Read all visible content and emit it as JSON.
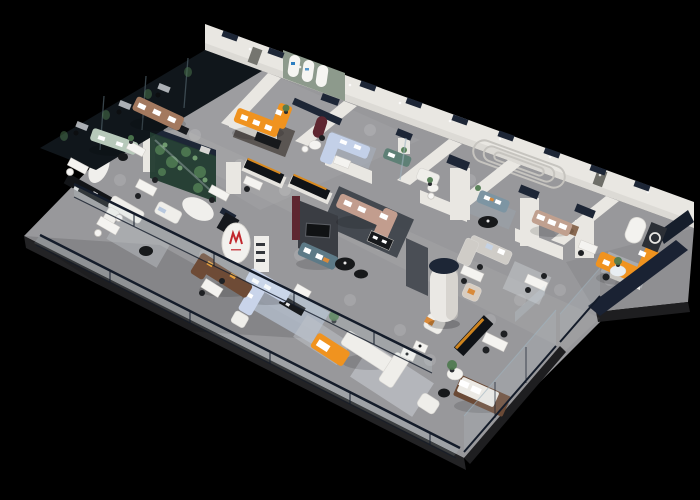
{
  "scene": {
    "render_type": "3d isometric cutaway floor-plan render",
    "subject": "furniture showroom and office interior, elevated axonometric view on black background",
    "areas": [
      "dark glass-walled offices (upper left)",
      "sage and tan sofa displays",
      "glass plant terrarium wall",
      "reception oval with red brand monogram",
      "arched gallery wall with orange corner sofa",
      "charcoal tv feature wall with teal and blush sectionals",
      "white cylinder column lounge",
      "open white sectional area with glass balustrades",
      "bedroom display with wood bed",
      "orange corner lounge at far right end"
    ]
  },
  "colors": {
    "background": "#000000",
    "floor": "#98989b",
    "floor_nook": "#8f8f92",
    "wall_white": "#e9e7e2",
    "wall_groove": "#c6c4bf",
    "cap_navy": "#1d2636",
    "sage_wall": "#8d9a8c",
    "glass_office": "#10161b",
    "glass_tint": "#cfe0ea",
    "terrarium_green": "#223c31",
    "plant_green": "#4e7a4f",
    "sofa_orange": "#f0931f",
    "sofa_white": "#efeeea",
    "sofa_blue": "#c9d4ea",
    "sofa_tan": "#a3795f",
    "sofa_blush": "#c29d8e",
    "sofa_sage": "#b7c9ba",
    "sofa_teal": "#5d7a87",
    "sofa_brown": "#6e4b36",
    "charcoal_wall": "#3a3d43",
    "maroon_accent": "#5e2630",
    "rug_dark": "#3a3f47",
    "rug_light": "#b0bac8",
    "table_white": "#f4f3f0",
    "chair_dark": "#1e2023",
    "rail_navy": "#141c2a",
    "navy_wall": "#1a2233",
    "wood_bed": "#6b4a36",
    "gold_trim": "#d98a1f",
    "logo_red": "#c1272d",
    "logo_blue": "#2e7fc1"
  }
}
